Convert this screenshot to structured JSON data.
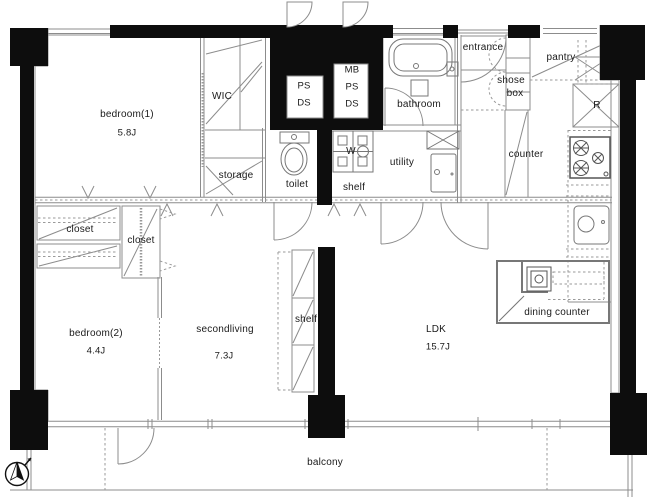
{
  "rooms": {
    "bedroom1": {
      "name": "bedroom(1)",
      "area": "5.8J"
    },
    "wic": {
      "name": "WIC"
    },
    "storage": {
      "name": "storage"
    },
    "shaft1": {
      "line1": "PS",
      "line2": "DS"
    },
    "shaft2": {
      "line1": "MB",
      "line2": "PS",
      "line3": "DS"
    },
    "bathroom": {
      "name": "bathroom"
    },
    "toilet": {
      "name": "toilet"
    },
    "washer": {
      "name": "W"
    },
    "utility_shelf": {
      "name": "shelf"
    },
    "utility": {
      "name": "utility"
    },
    "entrance": {
      "name": "entrance"
    },
    "shoebox": {
      "line1": "shose",
      "line2": "box"
    },
    "pantry": {
      "name": "pantry"
    },
    "refrigerator": {
      "name": "R"
    },
    "counter": {
      "name": "counter"
    },
    "closet_a": {
      "name": "closet"
    },
    "closet_b": {
      "name": "closet"
    },
    "bedroom2": {
      "name": "bedroom(2)",
      "area": "4.4J"
    },
    "secondliving": {
      "name": "secondliving",
      "area": "7.3J"
    },
    "living_shelf": {
      "name": "shelf"
    },
    "ldk": {
      "name": "LDK",
      "area": "15.7J"
    },
    "dining_counter": {
      "name": "dining counter"
    },
    "balcony": {
      "name": "balcony"
    }
  },
  "colors": {
    "wall": "#0d0d0d",
    "line": "#8c8c8c"
  }
}
